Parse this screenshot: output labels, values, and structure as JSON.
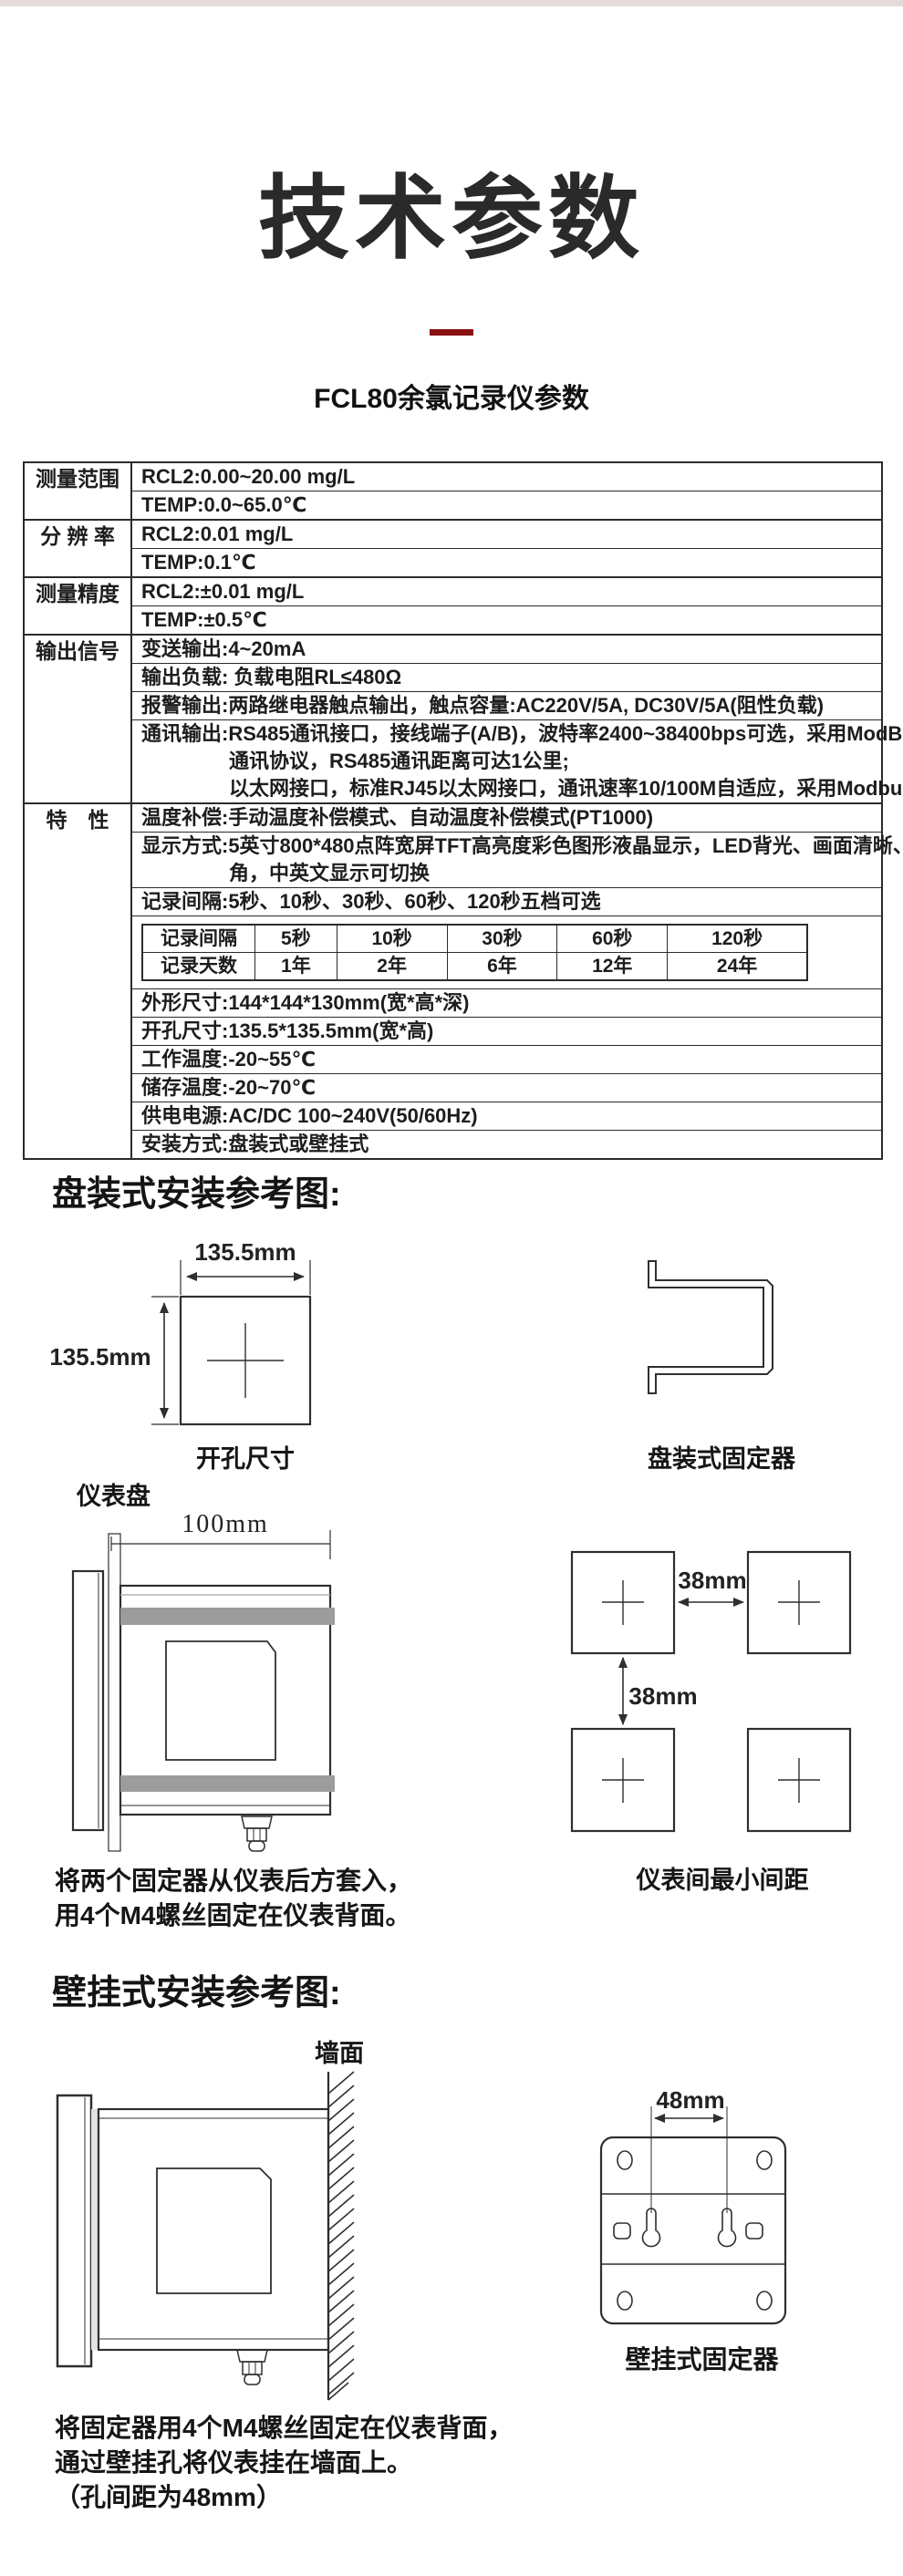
{
  "page": {
    "top_strip_color": "#e5dbdb",
    "accent_color": "#8a1111",
    "ink_color": "#2b2a2a"
  },
  "header": {
    "title": "技术参数",
    "subtitle": "FCL80余氯记录仪参数"
  },
  "spec": {
    "g1_label": "测量范围",
    "g1_r1": "RCL2:0.00~20.00 mg/L",
    "g1_r2": "TEMP:0.0~65.0℃",
    "g2_label": "分 辨 率",
    "g2_r1": "RCL2:0.01 mg/L",
    "g2_r2": "TEMP:0.1℃",
    "g3_label": "测量精度",
    "g3_r1": "RCL2:±0.01 mg/L",
    "g3_r2": "TEMP:±0.5℃",
    "g4_label": "输出信号",
    "g4_r1": "变送输出:4~20mA",
    "g4_r2": "输出负载: 负载电阻RL≤480Ω",
    "g4_r3": "报警输出:两路继电器触点输出，触点容量:AC220V/5A, DC30V/5A(阻性负载)",
    "g4_r4_l1": "通讯输出:RS485通讯接口，接线端子(A/B)，波特率2400~38400bps可选，采用ModBus-RTU",
    "g4_r4_l2": "通讯协议，RS485通讯距离可达1公里;",
    "g4_r4_l3": "以太网接口，标准RJ45以太网接口，通讯速率10/100M自适应，采用Modbus-TCP协议",
    "g5_label": "特　性",
    "g5_r1": "温度补偿:手动温度补偿模式、自动温度补偿模式(PT1000)",
    "g5_r2_l1": "显示方式:5英寸800*480点阵宽屏TFT高亮度彩色图形液晶显示，LED背光、画面清晰、宽视",
    "g5_r2_l2": "角，中英文显示可切换",
    "g5_r3": "记录间隔:5秒、10秒、30秒、60秒、120秒五档可选",
    "record_table": {
      "header": [
        "记录间隔",
        "5秒",
        "10秒",
        "30秒",
        "60秒",
        "120秒"
      ],
      "days": [
        "记录天数",
        "1年",
        "2年",
        "6年",
        "12年",
        "24年"
      ]
    },
    "g5_r5": "外形尺寸:144*144*130mm(宽*高*深)",
    "g5_r6": "开孔尺寸:135.5*135.5mm(宽*高)",
    "g5_r7": "工作温度:-20~55℃",
    "g5_r8": "储存温度:-20~70℃",
    "g5_r9": "供电电源:AC/DC 100~240V(50/60Hz)",
    "g5_r10": "安装方式:盘装式或壁挂式"
  },
  "panel_section": {
    "heading": "盘装式安装参考图:",
    "cutout_width": "135.5mm",
    "cutout_height": "135.5mm",
    "cutout_caption": "开孔尺寸",
    "bracket_caption": "盘装式固定器",
    "panel_label": "仪表盘",
    "depth_dim": "100mm",
    "gap_h": "38mm",
    "gap_v": "38mm",
    "spacing_caption": "仪表间最小间距",
    "note_l1": "将两个固定器从仪表后方套入，",
    "note_l2": "用4个M4螺丝固定在仪表背面。"
  },
  "wall_section": {
    "heading": "壁挂式安装参考图:",
    "wall_label": "墙面",
    "hole_dim": "48mm",
    "bracket_caption": "壁挂式固定器",
    "note_l1": "将固定器用4个M4螺丝固定在仪表背面，",
    "note_l2": "通过壁挂孔将仪表挂在墙面上。",
    "note_l3": "（孔间距为48mm）"
  }
}
